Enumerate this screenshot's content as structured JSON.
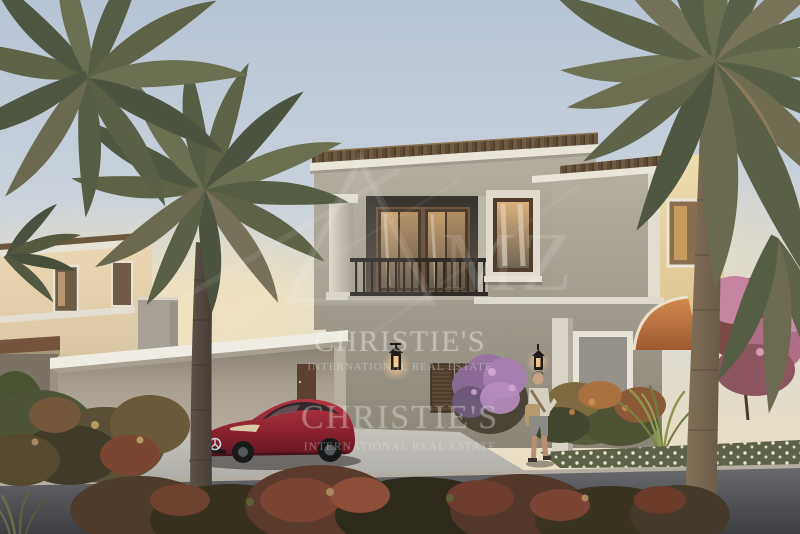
{
  "watermarks": {
    "brand": "CHRISTIE'S",
    "brand_sub": "INTERNATIONAL REAL ESTATE",
    "logo_letters": "MZ"
  },
  "scene": {
    "palette": {
      "sky_top": "#b7c4d4",
      "sky_horizon": "#f1e5c8",
      "villa_wall": "#aba59a",
      "villa_wall_lit": "#ead9a8",
      "roof_tile": "#5f4c38",
      "trim_white": "#e9e5d9",
      "terracotta": "#c97f48",
      "driveway": "#c2bfb8",
      "street": "#46484c",
      "car_red": "#8c2230",
      "foliage": "#5a604a",
      "flower_purple": "#a57fae",
      "flower_pink": "#c585a0",
      "lantern_glow": "#ffcf8e"
    }
  }
}
